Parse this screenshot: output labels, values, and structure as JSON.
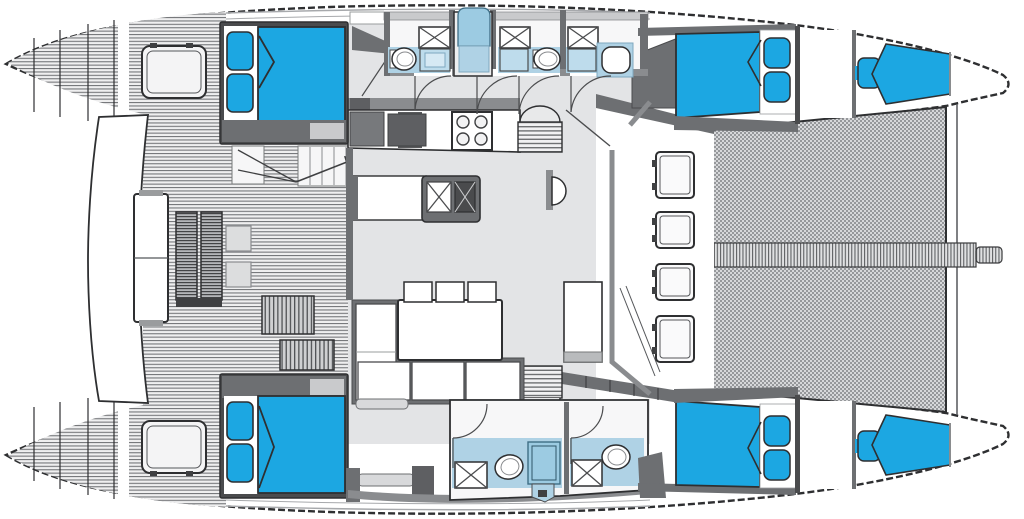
{
  "meta": {
    "label": "Catamaran yacht deck and interior layout floor plan, top view, bows to the right",
    "diagram_type": "floor-plan"
  },
  "colors": {
    "outline": "#2E2F31",
    "wall_dark": "#414042",
    "wall_mid": "#6D6F72",
    "wall_gray": "#8A8C8F",
    "wall_light": "#C9CACC",
    "floor_gray": "#E3E4E6",
    "berth_blue": "#1CA7E2",
    "bath_floor": "#AFD2E5",
    "bath_fixture": "#BEDCEC",
    "shower_blue": "#9CCBE2",
    "deck_line": "#75777A",
    "mesh_dark": "#96989B",
    "mesh_light": "#D7D8DA",
    "paper_white": "#FFFFFF"
  },
  "layout": {
    "hulls": [
      {
        "id": "port-hull",
        "position": "top",
        "rooms": [
          "aft-double-cabin",
          "head-compartment-1",
          "shower-stall",
          "head-compartment-2",
          "head-compartment-3",
          "forward-double-cabin",
          "crew-berth-bow"
        ]
      },
      {
        "id": "starboard-hull",
        "position": "bottom",
        "rooms": [
          "aft-double-cabin",
          "head-compartment-4",
          "head-compartment-5",
          "forward-double-cabin",
          "crew-berth-bow"
        ]
      }
    ],
    "bridgedeck": {
      "rooms": [
        "aft-cockpit",
        "salon",
        "galley",
        "forward-cockpit",
        "trampoline"
      ]
    },
    "fixture_counts": {
      "double_berths": 4,
      "crew_berths": 2,
      "berth_pillows": 10,
      "toilets": 5,
      "sink_basins_heads": 5,
      "shower_trays": 6,
      "galley_stove_burners": 4,
      "galley_sink_basins": 2,
      "salon_stools": 3,
      "foredeck_hatches": 4,
      "hull_deck_hatches": 2,
      "door_swings": 6,
      "companionway_stairs": 2,
      "cockpit_ladders": 2
    }
  }
}
